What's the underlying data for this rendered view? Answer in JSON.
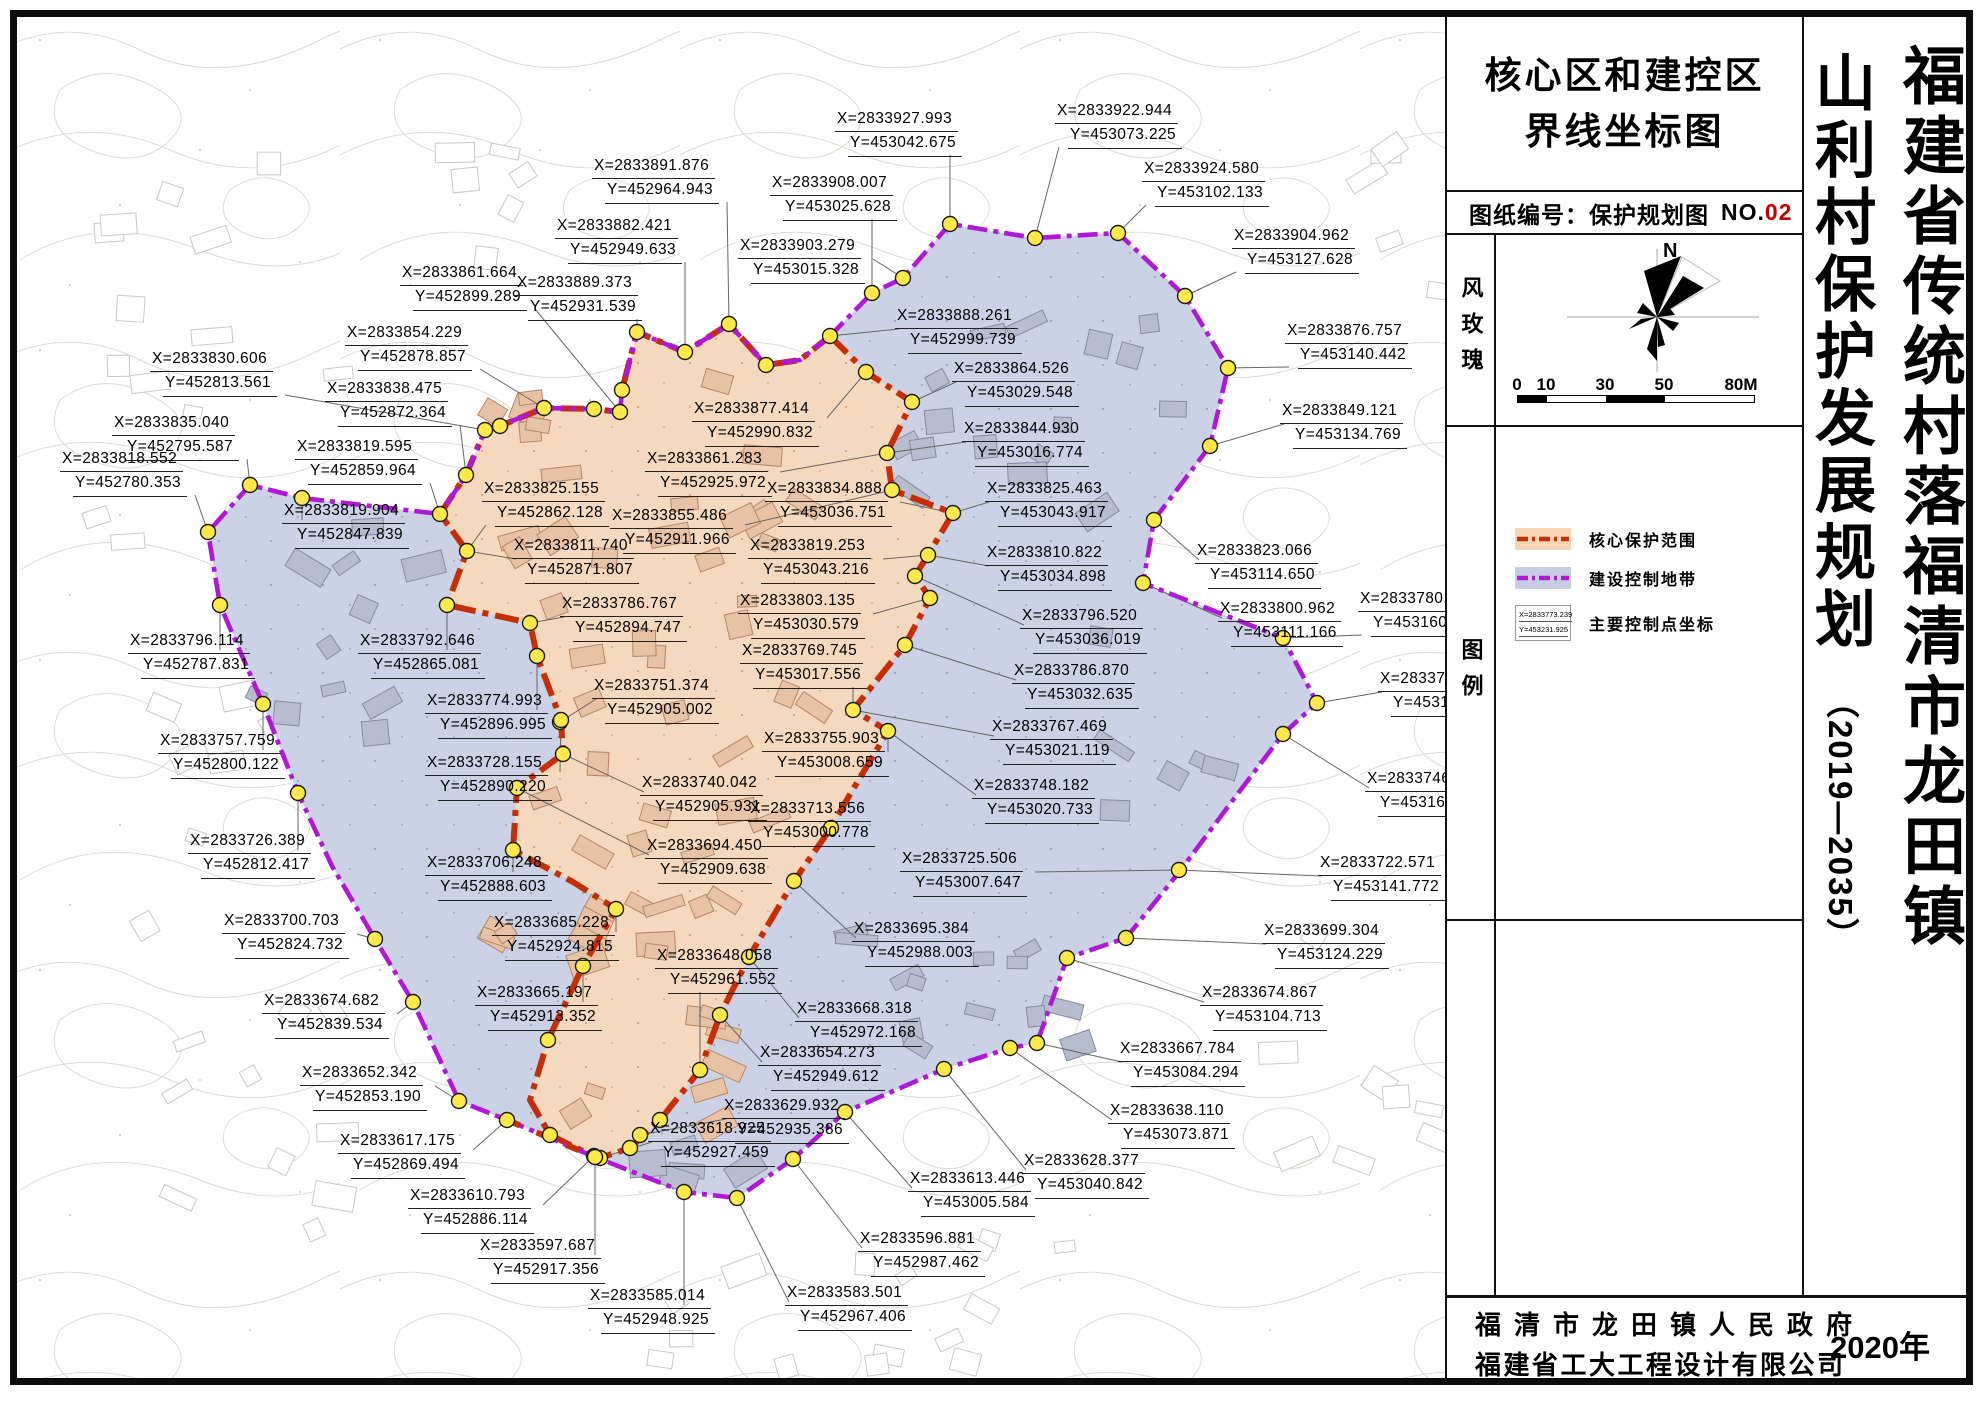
{
  "title_block": {
    "line1": "核心区和建控区",
    "line2": "界线坐标图"
  },
  "sheet_no": {
    "label": "图纸编号：保护规划图",
    "no_prefix": "NO.",
    "no_value": "02"
  },
  "wind_rose": {
    "label": "风玫瑰",
    "north": "N",
    "scale_ticks": [
      "0",
      "10",
      "30",
      "50",
      "80M"
    ]
  },
  "legend": {
    "label": "图例",
    "items": [
      {
        "name": "核心保护范围"
      },
      {
        "name": "建设控制地带"
      },
      {
        "name": "主要控制点坐标",
        "sample_x": "X=2833773.239",
        "sample_y": "Y=453231.925"
      }
    ]
  },
  "side_title": {
    "main": "山利村保护发展规划",
    "years": "（2019—2035）",
    "region": "福建省传统村落福清市龙田镇"
  },
  "publisher": {
    "line1": "福清市龙田镇人民政府",
    "line2": "福建省工大工程设计有限公司",
    "year": "2020年"
  },
  "map": {
    "colors": {
      "control_fill": "#c8cee3",
      "core_fill": "#f6d9bc",
      "control_stroke": "#ae18d6",
      "core_stroke": "#c62f06",
      "point_fill": "#ffe94a",
      "leader": "#666666"
    },
    "outer_ring": [
      [
        830,
        336
      ],
      [
        800,
        360
      ],
      [
        766,
        365
      ],
      [
        729,
        324
      ],
      [
        685,
        352
      ],
      [
        637,
        332
      ],
      [
        622,
        390
      ],
      [
        620,
        412
      ],
      [
        594,
        409
      ],
      [
        544,
        408
      ],
      [
        500,
        426
      ],
      [
        485,
        430
      ],
      [
        466,
        475
      ],
      [
        440,
        514
      ],
      [
        302,
        498
      ],
      [
        250,
        485
      ],
      [
        208,
        532
      ],
      [
        220,
        605
      ],
      [
        263,
        704
      ],
      [
        298,
        793
      ],
      [
        332,
        866
      ],
      [
        375,
        939
      ],
      [
        413,
        1002
      ],
      [
        459,
        1101
      ],
      [
        507,
        1120
      ],
      [
        595,
        1157
      ],
      [
        684,
        1192
      ],
      [
        737,
        1198
      ],
      [
        793,
        1159
      ],
      [
        845,
        1112
      ],
      [
        944,
        1069
      ],
      [
        1010,
        1048
      ],
      [
        1037,
        1043
      ],
      [
        1067,
        958
      ],
      [
        1126,
        938
      ],
      [
        1180,
        871
      ],
      [
        1230,
        804
      ],
      [
        1283,
        734
      ],
      [
        1317,
        703
      ],
      [
        1283,
        638
      ],
      [
        1143,
        583
      ],
      [
        1154,
        520
      ],
      [
        1210,
        446
      ],
      [
        1228,
        368
      ],
      [
        1185,
        296
      ],
      [
        1118,
        233
      ],
      [
        1035,
        238
      ],
      [
        950,
        224
      ],
      [
        903,
        278
      ],
      [
        872,
        293
      ]
    ],
    "core_ring": [
      [
        830,
        336
      ],
      [
        866,
        372
      ],
      [
        912,
        402
      ],
      [
        887,
        453
      ],
      [
        892,
        490
      ],
      [
        953,
        513
      ],
      [
        928,
        555
      ],
      [
        915,
        576
      ],
      [
        930,
        598
      ],
      [
        905,
        645
      ],
      [
        853,
        710
      ],
      [
        888,
        731
      ],
      [
        849,
        796
      ],
      [
        831,
        828
      ],
      [
        794,
        881
      ],
      [
        749,
        957
      ],
      [
        720,
        1015
      ],
      [
        700,
        1070
      ],
      [
        660,
        1120
      ],
      [
        630,
        1148
      ],
      [
        600,
        1158
      ],
      [
        595,
        1157
      ],
      [
        550,
        1135
      ],
      [
        530,
        1100
      ],
      [
        548,
        1040
      ],
      [
        583,
        966
      ],
      [
        616,
        909
      ],
      [
        573,
        882
      ],
      [
        513,
        850
      ],
      [
        517,
        788
      ],
      [
        563,
        754
      ],
      [
        561,
        720
      ],
      [
        537,
        656
      ],
      [
        530,
        623
      ],
      [
        447,
        605
      ],
      [
        467,
        551
      ],
      [
        440,
        514
      ],
      [
        466,
        475
      ],
      [
        485,
        430
      ],
      [
        500,
        426
      ],
      [
        544,
        408
      ],
      [
        594,
        409
      ],
      [
        620,
        412
      ],
      [
        622,
        390
      ],
      [
        637,
        332
      ],
      [
        685,
        352
      ],
      [
        729,
        324
      ],
      [
        766,
        365
      ],
      [
        800,
        360
      ]
    ],
    "corun_red_overlay": [
      [
        507,
        1120
      ],
      [
        595,
        1157
      ]
    ],
    "extra_points": [
      [
        766,
        365
      ],
      [
        830,
        336
      ],
      [
        302,
        498
      ],
      [
        622,
        390
      ],
      [
        594,
        409
      ],
      [
        500,
        426
      ],
      [
        548,
        1040
      ],
      [
        550,
        1135
      ],
      [
        630,
        1148
      ],
      [
        660,
        1120
      ],
      [
        845,
        1112
      ],
      [
        1010,
        1048
      ]
    ],
    "control_points": [
      {
        "x": "X=2833830.606",
        "y": "Y=452813.561",
        "lx": 150,
        "ly": 348,
        "px": 485,
        "py": 430
      },
      {
        "x": "X=2833835.040",
        "y": "Y=452795.587",
        "lx": 112,
        "ly": 412,
        "px": 250,
        "py": 485
      },
      {
        "x": "X=2833818.552",
        "y": "Y=452780.353",
        "lx": 60,
        "ly": 448,
        "px": 208,
        "py": 532
      },
      {
        "x": "X=2833838.475",
        "y": "Y=452872.364",
        "lx": 325,
        "ly": 378,
        "px": 466,
        "py": 475
      },
      {
        "x": "X=2833819.595",
        "y": "Y=452859.964",
        "lx": 295,
        "ly": 436,
        "px": 440,
        "py": 514
      },
      {
        "x": "X=2833854.229",
        "y": "Y=452878.857",
        "lx": 345,
        "ly": 322,
        "px": 544,
        "py": 408
      },
      {
        "x": "X=2833861.664",
        "y": "Y=452899.289",
        "lx": 400,
        "ly": 262,
        "px": 620,
        "py": 412
      },
      {
        "x": "X=2833889.373",
        "y": "Y=452931.539",
        "lx": 515,
        "ly": 272,
        "px": 637,
        "py": 332
      },
      {
        "x": "X=2833882.421",
        "y": "Y=452949.633",
        "lx": 555,
        "ly": 215,
        "px": 685,
        "py": 352
      },
      {
        "x": "X=2833891.876",
        "y": "Y=452964.943",
        "lx": 592,
        "ly": 155,
        "px": 729,
        "py": 324
      },
      {
        "x": "X=2833819.904",
        "y": "Y=452847.839",
        "lx": 282,
        "ly": 500,
        "px": 302,
        "py": 498
      },
      {
        "x": "X=2833796.114",
        "y": "Y=452787.831",
        "lx": 128,
        "ly": 630,
        "px": 220,
        "py": 605
      },
      {
        "x": "X=2833757.759",
        "y": "Y=452800.122",
        "lx": 158,
        "ly": 730,
        "px": 263,
        "py": 704
      },
      {
        "x": "X=2833726.389",
        "y": "Y=452812.417",
        "lx": 188,
        "ly": 830,
        "px": 298,
        "py": 793
      },
      {
        "x": "X=2833700.703",
        "y": "Y=452824.732",
        "lx": 222,
        "ly": 910,
        "px": 375,
        "py": 939
      },
      {
        "x": "X=2833674.682",
        "y": "Y=452839.534",
        "lx": 262,
        "ly": 990,
        "px": 413,
        "py": 1002
      },
      {
        "x": "X=2833652.342",
        "y": "Y=452853.190",
        "lx": 300,
        "ly": 1062,
        "px": 459,
        "py": 1101
      },
      {
        "x": "X=2833617.175",
        "y": "Y=452869.494",
        "lx": 338,
        "ly": 1130,
        "px": 507,
        "py": 1120
      },
      {
        "x": "X=2833610.793",
        "y": "Y=452886.114",
        "lx": 408,
        "ly": 1185,
        "px": 594,
        "py": 1156
      },
      {
        "x": "X=2833908.007",
        "y": "Y=453025.628",
        "lx": 770,
        "ly": 172,
        "px": 872,
        "py": 293
      },
      {
        "x": "X=2833903.279",
        "y": "Y=453015.328",
        "lx": 738,
        "ly": 235,
        "px": 903,
        "py": 278
      },
      {
        "x": "X=2833927.993",
        "y": "Y=453042.675",
        "lx": 835,
        "ly": 108,
        "px": 950,
        "py": 224
      },
      {
        "x": "X=2833922.944",
        "y": "Y=453073.225",
        "lx": 1055,
        "ly": 100,
        "px": 1035,
        "py": 238
      },
      {
        "x": "X=2833924.580",
        "y": "Y=453102.133",
        "lx": 1142,
        "ly": 158,
        "px": 1118,
        "py": 233
      },
      {
        "x": "X=2833904.962",
        "y": "Y=453127.628",
        "lx": 1232,
        "ly": 225,
        "px": 1185,
        "py": 296
      },
      {
        "x": "X=2833876.757",
        "y": "Y=453140.442",
        "lx": 1285,
        "ly": 320,
        "px": 1228,
        "py": 368
      },
      {
        "x": "X=2833849.121",
        "y": "Y=453134.769",
        "lx": 1280,
        "ly": 400,
        "px": 1210,
        "py": 446
      },
      {
        "x": "X=2833888.261",
        "y": "Y=452999.739",
        "lx": 895,
        "ly": 305,
        "px": 830,
        "py": 336
      },
      {
        "x": "X=2833864.526",
        "y": "Y=453029.548",
        "lx": 952,
        "ly": 358,
        "px": 912,
        "py": 402
      },
      {
        "x": "X=2833844.930",
        "y": "Y=453016.774",
        "lx": 962,
        "ly": 418,
        "px": 887,
        "py": 453
      },
      {
        "x": "X=2833825.463",
        "y": "Y=453043.917",
        "lx": 985,
        "ly": 478,
        "px": 953,
        "py": 513
      },
      {
        "x": "X=2833810.822",
        "y": "Y=453034.898",
        "lx": 985,
        "ly": 542,
        "px": 928,
        "py": 555
      },
      {
        "x": "X=2833796.520",
        "y": "Y=453036.019",
        "lx": 1020,
        "ly": 605,
        "px": 915,
        "py": 576
      },
      {
        "x": "X=2833786.870",
        "y": "Y=453032.635",
        "lx": 1012,
        "ly": 660,
        "px": 905,
        "py": 645
      },
      {
        "x": "X=2833767.469",
        "y": "Y=453021.119",
        "lx": 990,
        "ly": 716,
        "px": 853,
        "py": 710
      },
      {
        "x": "X=2833748.182",
        "y": "Y=453020.733",
        "lx": 972,
        "ly": 775,
        "px": 888,
        "py": 731
      },
      {
        "x": "X=2833725.506",
        "y": "Y=453007.647",
        "lx": 900,
        "ly": 848,
        "px": 1179,
        "py": 870
      },
      {
        "x": "X=2833695.384",
        "y": "Y=452988.003",
        "lx": 852,
        "ly": 918,
        "px": 794,
        "py": 881
      },
      {
        "x": "X=2833823.066",
        "y": "Y=453114.650",
        "lx": 1195,
        "ly": 540,
        "px": 1154,
        "py": 520
      },
      {
        "x": "X=2833800.962",
        "y": "Y=453111.166",
        "lx": 1218,
        "ly": 598,
        "px": 1143,
        "py": 583
      },
      {
        "x": "X=2833780.959",
        "y": "Y=453160.474",
        "lx": 1358,
        "ly": 588,
        "px": 1283,
        "py": 638
      },
      {
        "x": "X=2833758.234",
        "y": "Y=453172.463",
        "lx": 1378,
        "ly": 668,
        "px": 1317,
        "py": 703
      },
      {
        "x": "X=2833746.720",
        "y": "Y=453160.836",
        "lx": 1365,
        "ly": 768,
        "px": 1283,
        "py": 734
      },
      {
        "x": "X=2833722.571",
        "y": "Y=453141.772",
        "lx": 1318,
        "ly": 852,
        "px": 1179,
        "py": 870
      },
      {
        "x": "X=2833699.304",
        "y": "Y=453124.229",
        "lx": 1262,
        "ly": 920,
        "px": 1126,
        "py": 938
      },
      {
        "x": "X=2833674.867",
        "y": "Y=453104.713",
        "lx": 1200,
        "ly": 982,
        "px": 1067,
        "py": 958
      },
      {
        "x": "X=2833667.784",
        "y": "Y=453084.294",
        "lx": 1118,
        "ly": 1038,
        "px": 1037,
        "py": 1043
      },
      {
        "x": "X=2833638.110",
        "y": "Y=453073.871",
        "lx": 1108,
        "ly": 1100,
        "px": 1010,
        "py": 1048
      },
      {
        "x": "X=2833628.377",
        "y": "Y=453040.842",
        "lx": 1022,
        "ly": 1150,
        "px": 944,
        "py": 1069
      },
      {
        "x": "X=2833613.446",
        "y": "Y=453005.584",
        "lx": 908,
        "ly": 1168,
        "px": 845,
        "py": 1112
      },
      {
        "x": "X=2833596.881",
        "y": "Y=452987.462",
        "lx": 858,
        "ly": 1228,
        "px": 793,
        "py": 1159
      },
      {
        "x": "X=2833583.501",
        "y": "Y=452967.406",
        "lx": 785,
        "ly": 1282,
        "px": 737,
        "py": 1198
      },
      {
        "x": "X=2833877.414",
        "y": "Y=452990.832",
        "lx": 692,
        "ly": 398,
        "px": 866,
        "py": 372
      },
      {
        "x": "X=2833861.283",
        "y": "Y=452925.972",
        "lx": 645,
        "ly": 448,
        "px": 887,
        "py": 453
      },
      {
        "x": "X=2833855.486",
        "y": "Y=452911.966",
        "lx": 610,
        "ly": 505,
        "px": 892,
        "py": 490
      },
      {
        "x": "X=2833825.155",
        "y": "Y=452862.128",
        "lx": 482,
        "ly": 478,
        "px": 467,
        "py": 551
      },
      {
        "x": "X=2833811.740",
        "y": "Y=452871.807",
        "lx": 512,
        "ly": 535,
        "px": 467,
        "py": 551
      },
      {
        "x": "X=2833834.888",
        "y": "Y=453036.751",
        "lx": 765,
        "ly": 478,
        "px": 953,
        "py": 513
      },
      {
        "x": "X=2833819.253",
        "y": "Y=453043.216",
        "lx": 748,
        "ly": 535,
        "px": 928,
        "py": 555
      },
      {
        "x": "X=2833803.135",
        "y": "Y=453030.579",
        "lx": 738,
        "ly": 590,
        "px": 930,
        "py": 598
      },
      {
        "x": "X=2833786.767",
        "y": "Y=452894.747",
        "lx": 560,
        "ly": 593,
        "px": 530,
        "py": 623
      },
      {
        "x": "X=2833769.745",
        "y": "Y=453017.556",
        "lx": 740,
        "ly": 640,
        "px": 853,
        "py": 710
      },
      {
        "x": "X=2833751.374",
        "y": "Y=452905.002",
        "lx": 592,
        "ly": 675,
        "px": 560,
        "py": 722
      },
      {
        "x": "X=2833755.903",
        "y": "Y=453008.659",
        "lx": 762,
        "ly": 728,
        "px": 888,
        "py": 731
      },
      {
        "x": "X=2833740.042",
        "y": "Y=452905.931",
        "lx": 640,
        "ly": 772,
        "px": 563,
        "py": 754
      },
      {
        "x": "X=2833713.556",
        "y": "Y=453000.778",
        "lx": 748,
        "ly": 798,
        "px": 831,
        "py": 828
      },
      {
        "x": "X=2833694.450",
        "y": "Y=452909.638",
        "lx": 645,
        "ly": 835,
        "px": 517,
        "py": 788
      },
      {
        "x": "X=2833706.248",
        "y": "Y=452888.603",
        "lx": 425,
        "ly": 852,
        "px": 513,
        "py": 850
      },
      {
        "x": "X=2833728.155",
        "y": "Y=452890.220",
        "lx": 425,
        "ly": 752,
        "px": 561,
        "py": 720
      },
      {
        "x": "X=2833774.993",
        "y": "Y=452896.995",
        "lx": 425,
        "ly": 690,
        "px": 537,
        "py": 656
      },
      {
        "x": "X=2833792.646",
        "y": "Y=452865.081",
        "lx": 358,
        "ly": 630,
        "px": 447,
        "py": 605
      },
      {
        "x": "X=2833685.228",
        "y": "Y=452924.815",
        "lx": 492,
        "ly": 912,
        "px": 616,
        "py": 909
      },
      {
        "x": "X=2833665.197",
        "y": "Y=452913.352",
        "lx": 475,
        "ly": 982,
        "px": 583,
        "py": 966
      },
      {
        "x": "X=2833648.058",
        "y": "Y=452961.552",
        "lx": 655,
        "ly": 945,
        "px": 700,
        "py": 1070
      },
      {
        "x": "X=2833654.273",
        "y": "Y=452949.612",
        "lx": 758,
        "ly": 1042,
        "px": 720,
        "py": 1015
      },
      {
        "x": "X=2833629.932",
        "y": "Y=452935.386",
        "lx": 722,
        "ly": 1095,
        "px": 640,
        "py": 1135
      },
      {
        "x": "X=2833618.925",
        "y": "Y=452927.459",
        "lx": 648,
        "ly": 1118,
        "px": 600,
        "py": 1158
      },
      {
        "x": "X=2833668.318",
        "y": "Y=452972.168",
        "lx": 795,
        "ly": 998,
        "px": 749,
        "py": 957
      },
      {
        "x": "X=2833597.687",
        "y": "Y=452917.356",
        "lx": 478,
        "ly": 1235,
        "px": 595,
        "py": 1157
      },
      {
        "x": "X=2833585.014",
        "y": "Y=452948.925",
        "lx": 588,
        "ly": 1285,
        "px": 684,
        "py": 1192
      }
    ]
  }
}
